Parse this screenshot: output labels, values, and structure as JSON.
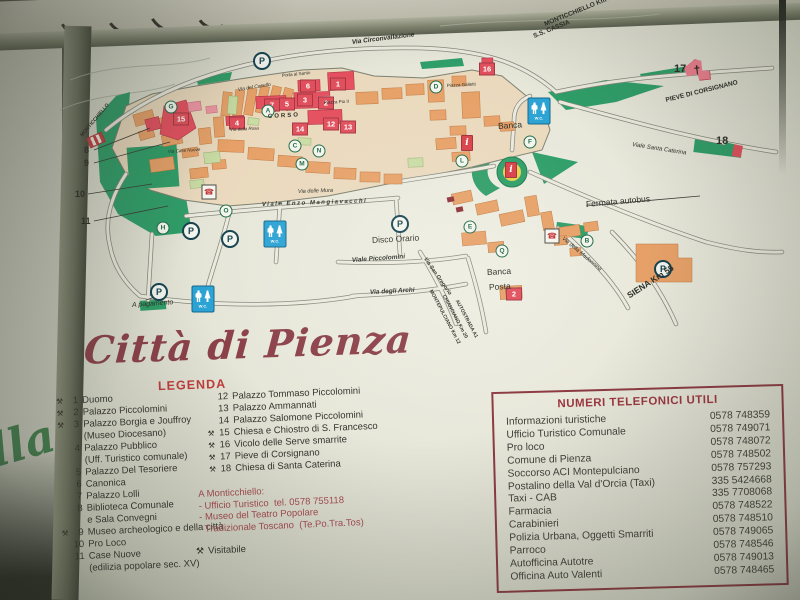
{
  "photo": {
    "neighbor_sign_fragment": "lla"
  },
  "sign": {
    "title": "Città di Pienza",
    "legend_title": "LEGENDA",
    "visitable_symbol": "⚒",
    "visitable_label": "Visitabile",
    "monticchiello_lines": [
      "A Monticchiello:",
      "- Ufficio Turistico  tel. 0578 755118",
      "- Museo del Teatro Popolare",
      "  Tradizionale Toscano  (Te.Po.Tra.Tos)"
    ]
  },
  "legend": {
    "left": [
      {
        "sym": true,
        "num": "1",
        "text": "Duomo"
      },
      {
        "sym": true,
        "num": "2",
        "text": "Palazzo Piccolomini"
      },
      {
        "sym": true,
        "num": "3",
        "text": "Palazzo Borgia e Jouffroy",
        "cont": [
          "(Museo Diocesano)"
        ]
      },
      {
        "sym": false,
        "num": "4",
        "text": "Palazzo Pubblico",
        "cont": [
          "(Uff. Turistico comunale)"
        ]
      },
      {
        "sym": false,
        "num": "5",
        "text": "Palazzo Del Tesoriere"
      },
      {
        "sym": false,
        "num": "6",
        "text": "Canonica"
      },
      {
        "sym": false,
        "num": "7",
        "text": "Palazzo Lolli"
      },
      {
        "sym": false,
        "num": "8",
        "text": "Biblioteca Comunale",
        "cont": [
          "e Sala Convegni"
        ]
      },
      {
        "sym": true,
        "num": "9",
        "text": "Museo archeologico e della città"
      },
      {
        "sym": false,
        "num": "10",
        "text": "Pro Loco"
      },
      {
        "sym": false,
        "num": "11",
        "text": "Case Nuove",
        "cont": [
          "(edilizia popolare sec. XV)"
        ]
      }
    ],
    "right": [
      {
        "sym": false,
        "num": "12",
        "text": "Palazzo Tommaso Piccolomini"
      },
      {
        "sym": false,
        "num": "13",
        "text": "Palazzo Ammannati"
      },
      {
        "sym": false,
        "num": "14",
        "text": "Palazzo Salomone Piccolomini"
      },
      {
        "sym": true,
        "num": "15",
        "text": "Chiesa e Chiostro di S. Francesco"
      },
      {
        "sym": true,
        "num": "16",
        "text": "Vicolo delle Serve smarrite"
      },
      {
        "sym": true,
        "num": "17",
        "text": "Pieve di Corsignano"
      },
      {
        "sym": true,
        "num": "18",
        "text": "Chiesa di Santa Caterina"
      }
    ]
  },
  "phones": {
    "title": "NUMERI TELEFONICI UTILI",
    "rows": [
      {
        "name": "Informazioni turistiche",
        "number": "0578 748359"
      },
      {
        "name": "Ufficio Turistico Comunale",
        "number": "0578 749071"
      },
      {
        "name": "Pro loco",
        "number": "0578 748072"
      },
      {
        "name": "Comune di Pienza",
        "number": "0578 748502"
      },
      {
        "name": "Soccorso ACI Montepulciano",
        "number": "0578 757293"
      },
      {
        "name": "Postalino della Val d'Orcia (Taxi)",
        "number": "335 5424668"
      },
      {
        "name": "Taxi - CAB",
        "number": "335 7708068"
      },
      {
        "name": "Farmacia",
        "number": "0578 748522"
      },
      {
        "name": "Carabinieri",
        "number": "0578 748510"
      },
      {
        "name": "Polizia Urbana, Oggetti Smarriti",
        "number": "0578 749065"
      },
      {
        "name": "Parroco",
        "number": "0578 748546"
      },
      {
        "name": "Autofficina Autotre",
        "number": "0578 749013"
      },
      {
        "name": "Officina Auto Valenti",
        "number": "0578 748465"
      }
    ]
  },
  "map": {
    "icons": {
      "parking": "P",
      "wc_label": "W.C.",
      "info": "i",
      "phone": "☎",
      "church_cross": "†"
    },
    "labels": [
      {
        "t": "Via Circonvallazione",
        "x": 352,
        "y": 40,
        "r": -7,
        "s": 6.5,
        "w": 1,
        "i": 1
      },
      {
        "t": "MONTICCHIELLO Km 10",
        "x": 545,
        "y": 22,
        "r": -22,
        "s": 6.5,
        "w": 1
      },
      {
        "t": "S.S. CASSIA",
        "x": 534,
        "y": 34,
        "r": -22,
        "s": 6.5,
        "w": 1
      },
      {
        "t": "PIEVE DI CORSIGNANO",
        "x": 666,
        "y": 98,
        "r": -14,
        "s": 6.5,
        "w": 1
      },
      {
        "t": "17",
        "x": 674,
        "y": 64,
        "r": 0,
        "s": 11,
        "w": 1
      },
      {
        "t": "18",
        "x": 716,
        "y": 136,
        "r": 0,
        "s": 11,
        "w": 1
      },
      {
        "t": "Viale Santa Caterina",
        "x": 632,
        "y": 142,
        "r": 9,
        "s": 6,
        "i": 1
      },
      {
        "t": "Banca",
        "x": 498,
        "y": 122,
        "r": -4,
        "s": 8.5
      },
      {
        "t": "Fermata autobus",
        "x": 586,
        "y": 200,
        "r": -5,
        "s": 8.5
      },
      {
        "t": "Banca",
        "x": 487,
        "y": 268,
        "r": -3,
        "s": 8.5
      },
      {
        "t": "Posta",
        "x": 489,
        "y": 283,
        "r": -3,
        "s": 8.5
      },
      {
        "t": "Disco Orario",
        "x": 372,
        "y": 236,
        "r": -3,
        "s": 8.5
      },
      {
        "t": "A pagamento",
        "x": 132,
        "y": 302,
        "r": -4,
        "s": 7,
        "i": 1
      },
      {
        "t": "SIENA Km 55",
        "x": 628,
        "y": 292,
        "r": -33,
        "s": 8.5,
        "w": 1
      },
      {
        "t": "MONTEPULCIANO Km 12",
        "x": 430,
        "y": 288,
        "r": 62,
        "s": 5,
        "w": 1
      },
      {
        "t": "CHIANCIANO Km 20",
        "x": 443,
        "y": 293,
        "r": 62,
        "s": 5,
        "w": 1
      },
      {
        "t": "AUTOSTRADA A1",
        "x": 456,
        "y": 298,
        "r": 62,
        "s": 5,
        "w": 1
      },
      {
        "t": "CORSO",
        "x": 268,
        "y": 114,
        "r": -3,
        "s": 6,
        "w": 1,
        "sp": 2
      },
      {
        "t": "Viale Piccolomini",
        "x": 352,
        "y": 258,
        "r": -4,
        "s": 6.5,
        "w": 1,
        "i": 1
      },
      {
        "t": "Via degli Archi",
        "x": 370,
        "y": 290,
        "r": -3,
        "s": 6.5,
        "w": 1,
        "i": 1
      },
      {
        "t": "Via San Gregorio",
        "x": 424,
        "y": 256,
        "r": 55,
        "s": 5.5,
        "w": 1,
        "i": 1
      },
      {
        "t": "Viale  Enzo  Mangiavacchi",
        "x": 262,
        "y": 202,
        "r": -2,
        "s": 6,
        "w": 1,
        "i": 1,
        "sp": 1.5
      },
      {
        "t": "Via della Madonnina",
        "x": 562,
        "y": 236,
        "r": 40,
        "s": 5.5,
        "i": 1
      },
      {
        "t": "Via delle Mura",
        "x": 298,
        "y": 190,
        "r": -2,
        "s": 5.5,
        "i": 1
      },
      {
        "t": "MONTICCHIELLO",
        "x": 82,
        "y": 134,
        "r": -50,
        "s": 5,
        "w": 1
      },
      {
        "t": "Via del Casello",
        "x": 238,
        "y": 88,
        "r": -9,
        "s": 5,
        "i": 1
      },
      {
        "t": "Porta al Santo",
        "x": 282,
        "y": 74,
        "r": -6,
        "s": 4.5
      },
      {
        "t": "Piazza Galletti",
        "x": 447,
        "y": 84,
        "r": -3,
        "s": 4.5
      },
      {
        "t": "Via Case Nuove",
        "x": 168,
        "y": 150,
        "r": -4,
        "s": 4.5,
        "i": 1
      },
      {
        "t": "Via della Rosa",
        "x": 230,
        "y": 128,
        "r": -3,
        "s": 4.5,
        "i": 1
      },
      {
        "t": "Piazza Pio II",
        "x": 324,
        "y": 101,
        "r": -3,
        "s": 4.5
      },
      {
        "t": "8",
        "x": 84,
        "y": 146,
        "r": 0,
        "s": 9,
        "w": 1
      },
      {
        "t": "9",
        "x": 84,
        "y": 159,
        "r": 0,
        "s": 9,
        "w": 1
      },
      {
        "t": "10",
        "x": 75,
        "y": 190,
        "r": 0,
        "s": 9,
        "w": 1
      },
      {
        "t": "11",
        "x": 81,
        "y": 217,
        "r": 0,
        "s": 9,
        "w": 1
      }
    ],
    "number_markers": [
      {
        "n": "1",
        "x": 338,
        "y": 84
      },
      {
        "n": "6",
        "x": 308,
        "y": 86
      },
      {
        "n": "3",
        "x": 305,
        "y": 100
      },
      {
        "n": "5",
        "x": 287,
        "y": 104
      },
      {
        "n": "7",
        "x": 272,
        "y": 105
      },
      {
        "n": "2",
        "x": 326,
        "y": 103
      },
      {
        "n": "4",
        "x": 237,
        "y": 123
      },
      {
        "n": "12",
        "x": 331,
        "y": 124
      },
      {
        "n": "13",
        "x": 348,
        "y": 127
      },
      {
        "n": "14",
        "x": 300,
        "y": 129
      },
      {
        "n": "15",
        "x": 181,
        "y": 119
      },
      {
        "n": "16",
        "x": 487,
        "y": 69
      },
      {
        "n": "2",
        "x": 514,
        "y": 294
      }
    ],
    "letter_markers": [
      {
        "l": "G",
        "x": 171,
        "y": 107
      },
      {
        "l": "A",
        "x": 268,
        "y": 111
      },
      {
        "l": "C",
        "x": 295,
        "y": 146
      },
      {
        "l": "N",
        "x": 319,
        "y": 151
      },
      {
        "l": "M",
        "x": 302,
        "y": 164
      },
      {
        "l": "L",
        "x": 462,
        "y": 161
      },
      {
        "l": "E",
        "x": 470,
        "y": 227
      },
      {
        "l": "Q",
        "x": 502,
        "y": 251
      },
      {
        "l": "D",
        "x": 436,
        "y": 87
      },
      {
        "l": "F",
        "x": 530,
        "y": 142
      },
      {
        "l": "B",
        "x": 587,
        "y": 241
      },
      {
        "l": "H",
        "x": 163,
        "y": 228
      },
      {
        "l": "O",
        "x": 226,
        "y": 211
      }
    ],
    "parking": [
      {
        "x": 262,
        "y": 61
      },
      {
        "x": 400,
        "y": 224
      },
      {
        "x": 191,
        "y": 231
      },
      {
        "x": 230,
        "y": 239
      },
      {
        "x": 159,
        "y": 292
      },
      {
        "x": 663,
        "y": 269
      }
    ],
    "wc": [
      {
        "x": 539,
        "y": 111
      },
      {
        "x": 275,
        "y": 234
      },
      {
        "x": 203,
        "y": 299
      }
    ],
    "phones": [
      {
        "x": 209,
        "y": 192
      },
      {
        "x": 552,
        "y": 236
      }
    ],
    "info": [
      {
        "x": 467,
        "y": 143
      },
      {
        "x": 511,
        "y": 170
      }
    ],
    "church": {
      "x": 697,
      "y": 70
    },
    "marker18": {
      "x": 733,
      "y": 150
    },
    "monti_sign": {
      "x": 96,
      "y": 140
    }
  }
}
